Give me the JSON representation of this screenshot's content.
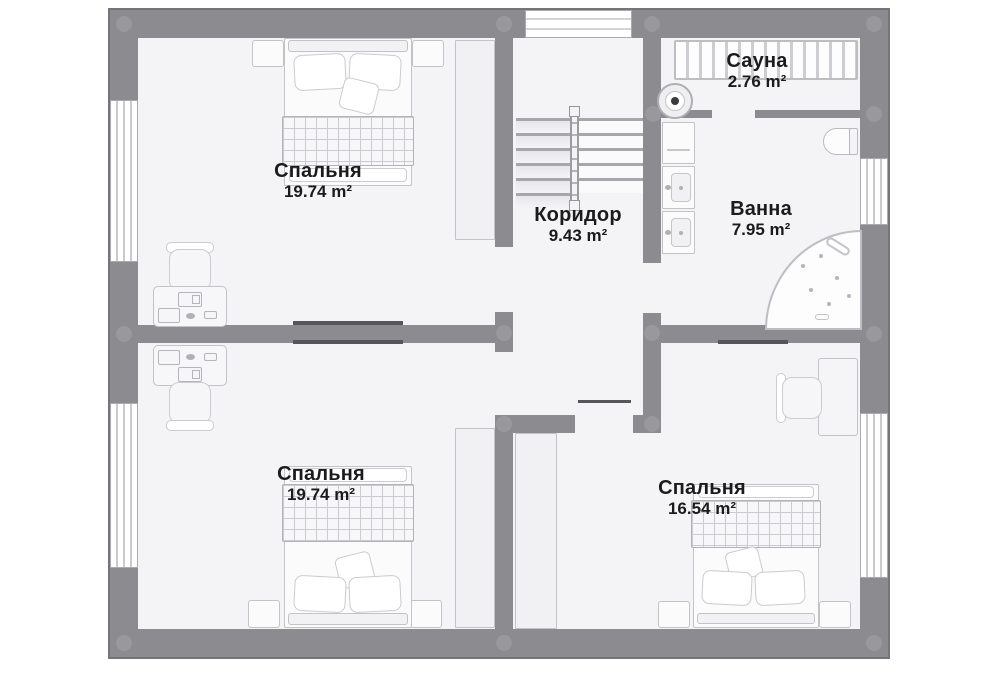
{
  "floorplan": {
    "rooms": [
      {
        "id": "bedroom-top-left",
        "label": "Спальня",
        "area": "19.74 m²"
      },
      {
        "id": "corridor",
        "label": "Коридор",
        "area": "9.43 m²"
      },
      {
        "id": "sauna",
        "label": "Сауна",
        "area": "2.76 m²"
      },
      {
        "id": "bathroom",
        "label": "Ванна",
        "area": "7.95 m²"
      },
      {
        "id": "bedroom-bottom-left",
        "label": "Спальня",
        "area": "19.74 m²"
      },
      {
        "id": "bedroom-bottom-right",
        "label": "Спальня",
        "area": "16.54 m²"
      }
    ],
    "colors": {
      "wall": "#8b8b90",
      "floor": "#f4f4f6",
      "text": "#1b1b1d",
      "furniture_outline": "#c2c2c7"
    }
  }
}
